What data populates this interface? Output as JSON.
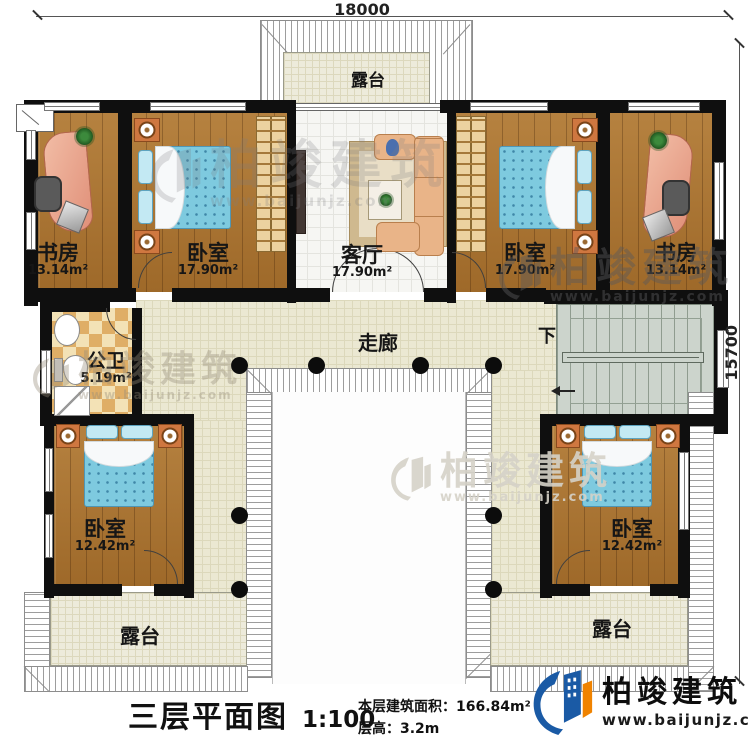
{
  "dimensions": {
    "width_top": "18000",
    "height_right": "15700"
  },
  "rooms": {
    "study_left": {
      "label": "书房",
      "area": "13.14m²"
    },
    "bedroom_top_left": {
      "label": "卧室",
      "area": "17.90m²"
    },
    "living_room": {
      "label": "客厅",
      "area": "17.90m²"
    },
    "bedroom_top_right": {
      "label": "卧室",
      "area": "17.90m²"
    },
    "study_right": {
      "label": "书房",
      "area": "13.14m²"
    },
    "bathroom": {
      "label": "公卫",
      "area": "5.19m²"
    },
    "bedroom_bottom_left": {
      "label": "卧室",
      "area": "12.42m²"
    },
    "bedroom_bottom_right": {
      "label": "卧室",
      "area": "12.42m²"
    }
  },
  "labels": {
    "terrace_top": "露台",
    "terrace_bottom_left": "露台",
    "terrace_bottom_right": "露台",
    "corridor": "走廊",
    "stairs_down": "下"
  },
  "title_block": {
    "title": "三层平面图",
    "scale": "1:100",
    "area_label": "本层建筑面积：",
    "area_value": "166.84m²",
    "height_label": "层高：",
    "height_value": "3.2m"
  },
  "branding": {
    "company": "柏竣建筑",
    "website": "www.baijunjz.com"
  },
  "colors": {
    "wall": "#0f0f0f",
    "wood_floor": "#a9722f",
    "bed": "#7ecadf",
    "corridor_floor": "#ebe8d2",
    "stair_floor": "#ccd4cc",
    "logo_blue": "#1a5aa5",
    "logo_orange": "#f08300"
  }
}
